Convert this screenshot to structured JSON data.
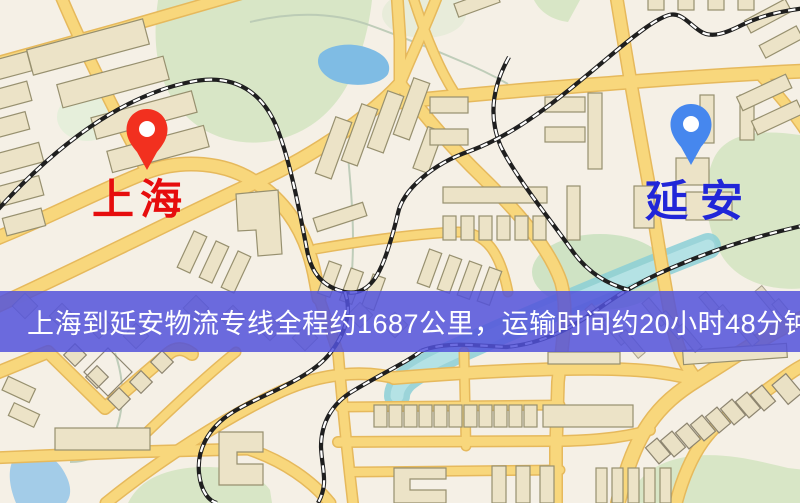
{
  "map": {
    "origin": {
      "label": "上海"
    },
    "destination": {
      "label": "延安"
    },
    "banner": {
      "text": "上海到延安物流专线全程约1687公里，运输时间约20小时48分钟."
    }
  },
  "colors": {
    "banner_bg": "rgba(82,82,218,0.85)",
    "origin_text": "#e60d0d",
    "destination_text": "#2126d8",
    "origin_pin": "#f2301f",
    "destination_pin": "#4687ee",
    "road": "#f8d77c",
    "park": "#d8e6c6",
    "water": "#7fbce4",
    "railway": "#1f1f1f"
  }
}
